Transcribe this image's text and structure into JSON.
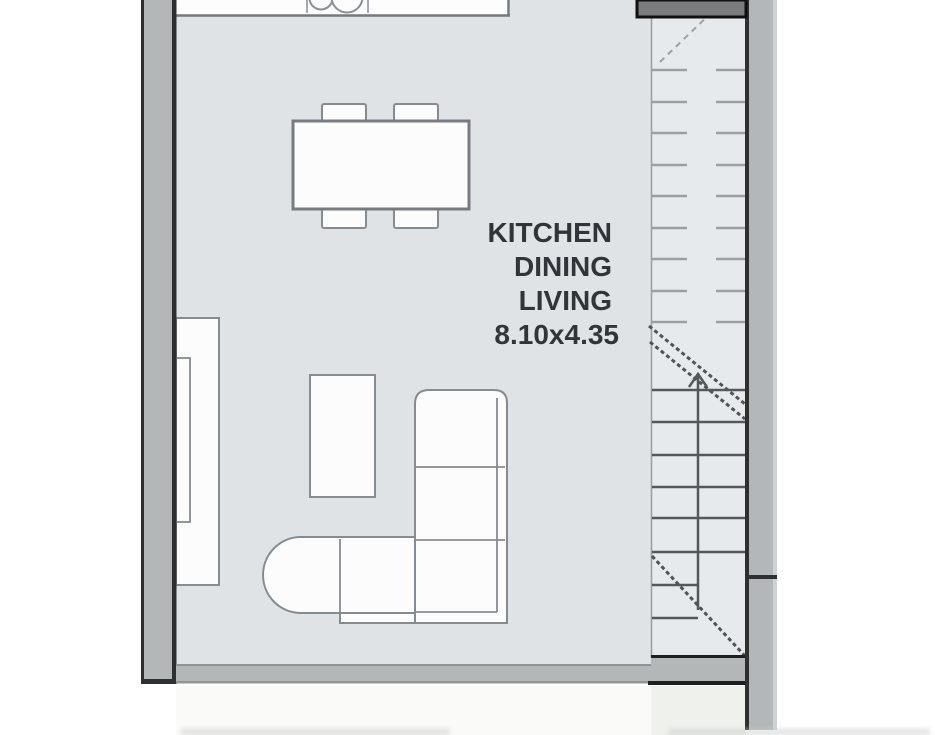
{
  "page": {
    "type": "architectural-floor-plan",
    "description": "Cropped floor plan view of an open-plan room with kitchen counter, dining table, L-shaped sofa and a staircase along the right wall"
  },
  "room_label": {
    "lines": [
      "KITCHEN",
      "DINING",
      "LIVING"
    ],
    "dimensions": "8.10x4.35"
  },
  "colors": {
    "outside": "#ffffff",
    "floor": "#dfe3e6",
    "stair_floor": "#e7eaec",
    "wall_fill": "#b4b7b8",
    "wall_edge": "#2d2f30",
    "furniture_line": "#868b8f",
    "furniture_fill": "#fcfcfd",
    "tread_light": "#9aa0a4",
    "tread_dark": "#55585a",
    "landing_fill": "#7a7d7e",
    "label_text": "#31353a",
    "below_stair_tint": "#eef1ec"
  }
}
